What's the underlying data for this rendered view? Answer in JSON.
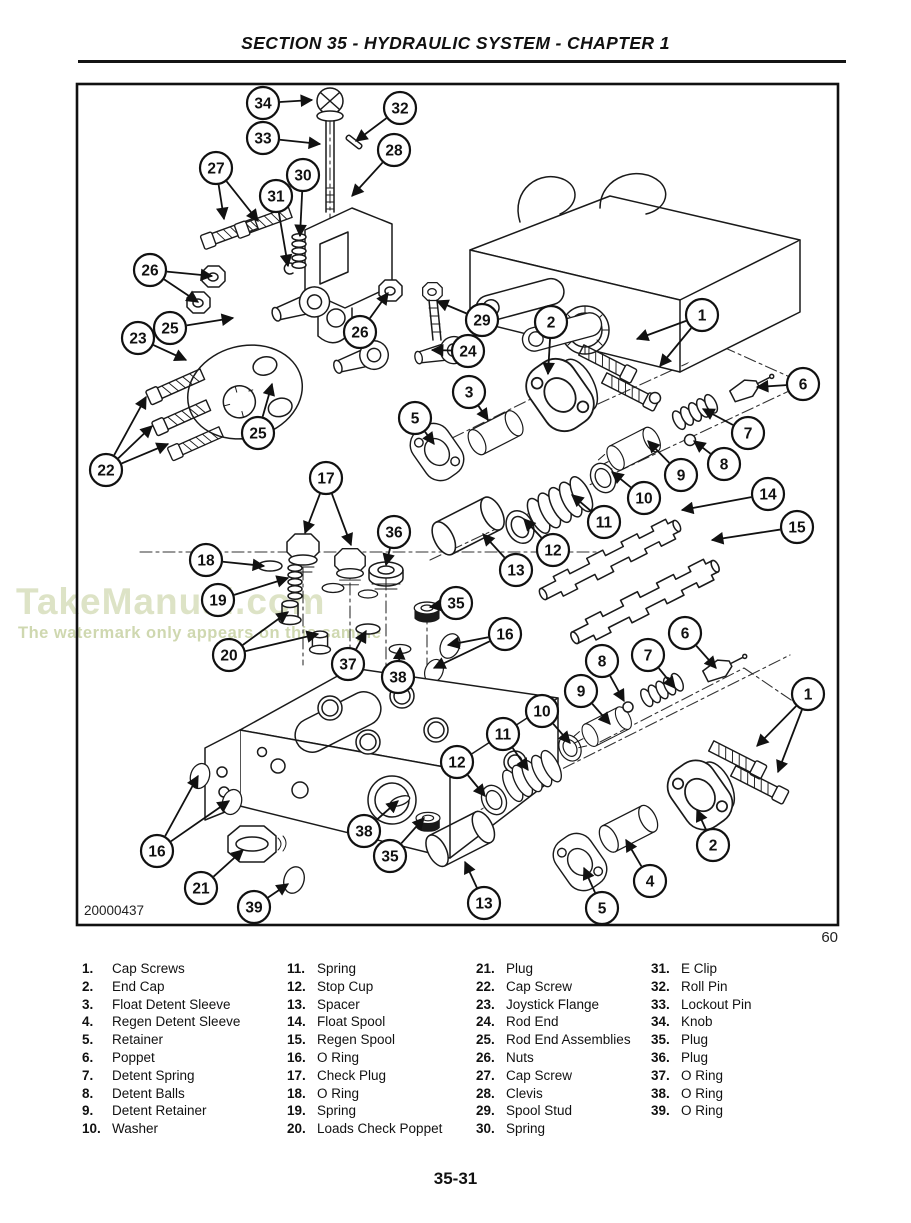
{
  "page": {
    "header_title": "SECTION 35 - HYDRAULIC SYSTEM - CHAPTER 1",
    "figure_number": "20000437",
    "figure_caption_number": "60",
    "footer_page_number": "35-31"
  },
  "watermark": {
    "title": "TakeManual.com",
    "subtitle": "The watermark only appears on this sample",
    "title_color": "#dde3c6",
    "subtitle_color": "#cfd8b0"
  },
  "diagram": {
    "description": "Exploded view of hydraulic joystick control valve",
    "callouts": [
      {
        "n": "34",
        "x": 263,
        "y": 103,
        "t": [
          [
            312,
            100
          ]
        ]
      },
      {
        "n": "32",
        "x": 400,
        "y": 108,
        "t": [
          [
            356,
            141
          ]
        ]
      },
      {
        "n": "33",
        "x": 263,
        "y": 138,
        "t": [
          [
            320,
            144
          ]
        ]
      },
      {
        "n": "28",
        "x": 394,
        "y": 150,
        "t": [
          [
            352,
            196
          ]
        ]
      },
      {
        "n": "27",
        "x": 216,
        "y": 168,
        "t": [
          [
            224,
            219
          ],
          [
            258,
            221
          ]
        ]
      },
      {
        "n": "30",
        "x": 303,
        "y": 175,
        "t": [
          [
            300,
            236
          ]
        ]
      },
      {
        "n": "31",
        "x": 276,
        "y": 196,
        "t": [
          [
            288,
            266
          ]
        ]
      },
      {
        "n": "26",
        "x": 150,
        "y": 270,
        "t": [
          [
            212,
            276
          ],
          [
            198,
            302
          ]
        ]
      },
      {
        "n": "25",
        "x": 170,
        "y": 328,
        "t": [
          [
            233,
            318
          ]
        ]
      },
      {
        "n": "23",
        "x": 138,
        "y": 338,
        "t": [
          [
            186,
            360
          ]
        ]
      },
      {
        "n": "26",
        "x": 360,
        "y": 332,
        "t": [
          [
            388,
            293
          ]
        ]
      },
      {
        "n": "29",
        "x": 482,
        "y": 320,
        "t": [
          [
            437,
            301
          ]
        ]
      },
      {
        "n": "24",
        "x": 468,
        "y": 351,
        "t": [
          [
            432,
            350
          ]
        ]
      },
      {
        "n": "25",
        "x": 258,
        "y": 433,
        "t": [
          [
            272,
            384
          ]
        ]
      },
      {
        "n": "22",
        "x": 106,
        "y": 470,
        "t": [
          [
            146,
            397
          ],
          [
            152,
            426
          ],
          [
            168,
            444
          ]
        ]
      },
      {
        "n": "3",
        "x": 469,
        "y": 392,
        "t": [
          [
            488,
            420
          ]
        ]
      },
      {
        "n": "5",
        "x": 415,
        "y": 418,
        "t": [
          [
            434,
            444
          ]
        ]
      },
      {
        "n": "2",
        "x": 551,
        "y": 322,
        "t": [
          [
            548,
            374
          ]
        ]
      },
      {
        "n": "1",
        "x": 702,
        "y": 315,
        "t": [
          [
            637,
            339
          ],
          [
            660,
            366
          ]
        ]
      },
      {
        "n": "6",
        "x": 803,
        "y": 384,
        "t": [
          [
            757,
            387
          ]
        ]
      },
      {
        "n": "7",
        "x": 748,
        "y": 433,
        "t": [
          [
            703,
            409
          ]
        ]
      },
      {
        "n": "8",
        "x": 724,
        "y": 464,
        "t": [
          [
            694,
            441
          ]
        ]
      },
      {
        "n": "9",
        "x": 681,
        "y": 475,
        "t": [
          [
            648,
            441
          ]
        ]
      },
      {
        "n": "10",
        "x": 644,
        "y": 498,
        "t": [
          [
            612,
            472
          ]
        ]
      },
      {
        "n": "11",
        "x": 604,
        "y": 522,
        "t": [
          [
            572,
            495
          ]
        ]
      },
      {
        "n": "12",
        "x": 553,
        "y": 550,
        "t": [
          [
            524,
            519
          ]
        ]
      },
      {
        "n": "14",
        "x": 768,
        "y": 494,
        "t": [
          [
            682,
            510
          ]
        ]
      },
      {
        "n": "15",
        "x": 797,
        "y": 527,
        "t": [
          [
            712,
            540
          ]
        ]
      },
      {
        "n": "13",
        "x": 516,
        "y": 570,
        "t": [
          [
            483,
            534
          ]
        ]
      },
      {
        "n": "17",
        "x": 326,
        "y": 478,
        "t": [
          [
            305,
            533
          ],
          [
            351,
            545
          ]
        ]
      },
      {
        "n": "18",
        "x": 206,
        "y": 560,
        "t": [
          [
            264,
            566
          ]
        ]
      },
      {
        "n": "19",
        "x": 218,
        "y": 600,
        "t": [
          [
            288,
            578
          ]
        ]
      },
      {
        "n": "36",
        "x": 394,
        "y": 532,
        "t": [
          [
            386,
            565
          ]
        ]
      },
      {
        "n": "35",
        "x": 456,
        "y": 603,
        "t": [
          [
            430,
            607
          ]
        ]
      },
      {
        "n": "16",
        "x": 505,
        "y": 634,
        "t": [
          [
            448,
            645
          ],
          [
            434,
            668
          ]
        ]
      },
      {
        "n": "20",
        "x": 229,
        "y": 655,
        "t": [
          [
            288,
            612
          ],
          [
            318,
            634
          ]
        ]
      },
      {
        "n": "37",
        "x": 348,
        "y": 664,
        "t": [
          [
            366,
            631
          ]
        ]
      },
      {
        "n": "38",
        "x": 398,
        "y": 677,
        "t": [
          [
            400,
            648
          ]
        ]
      },
      {
        "n": "6",
        "x": 685,
        "y": 633,
        "t": [
          [
            716,
            668
          ]
        ]
      },
      {
        "n": "7",
        "x": 648,
        "y": 655,
        "t": [
          [
            675,
            688
          ]
        ]
      },
      {
        "n": "8",
        "x": 602,
        "y": 661,
        "t": [
          [
            624,
            701
          ]
        ]
      },
      {
        "n": "9",
        "x": 581,
        "y": 691,
        "t": [
          [
            610,
            724
          ]
        ]
      },
      {
        "n": "10",
        "x": 542,
        "y": 711,
        "t": [
          [
            570,
            743
          ]
        ]
      },
      {
        "n": "11",
        "x": 503,
        "y": 734,
        "t": [
          [
            528,
            770
          ]
        ]
      },
      {
        "n": "12",
        "x": 457,
        "y": 762,
        "t": [
          [
            485,
            796
          ]
        ]
      },
      {
        "n": "1",
        "x": 808,
        "y": 694,
        "t": [
          [
            757,
            746
          ],
          [
            778,
            772
          ]
        ]
      },
      {
        "n": "2",
        "x": 713,
        "y": 845,
        "t": [
          [
            697,
            810
          ]
        ]
      },
      {
        "n": "4",
        "x": 650,
        "y": 881,
        "t": [
          [
            626,
            840
          ]
        ]
      },
      {
        "n": "5",
        "x": 602,
        "y": 908,
        "t": [
          [
            584,
            868
          ]
        ]
      },
      {
        "n": "13",
        "x": 484,
        "y": 903,
        "t": [
          [
            465,
            862
          ]
        ]
      },
      {
        "n": "35",
        "x": 390,
        "y": 856,
        "t": [
          [
            424,
            818
          ]
        ]
      },
      {
        "n": "38",
        "x": 364,
        "y": 831,
        "t": [
          [
            398,
            801
          ]
        ]
      },
      {
        "n": "16",
        "x": 157,
        "y": 851,
        "t": [
          [
            198,
            776
          ],
          [
            229,
            801
          ]
        ]
      },
      {
        "n": "21",
        "x": 201,
        "y": 888,
        "t": [
          [
            243,
            850
          ]
        ]
      },
      {
        "n": "39",
        "x": 254,
        "y": 907,
        "t": [
          [
            288,
            884
          ]
        ]
      }
    ]
  },
  "parts_list": {
    "columns": [
      [
        {
          "num": "1.",
          "label": "Cap Screws"
        },
        {
          "num": "2.",
          "label": "End Cap"
        },
        {
          "num": "3.",
          "label": "Float Detent Sleeve"
        },
        {
          "num": "4.",
          "label": "Regen Detent Sleeve"
        },
        {
          "num": "5.",
          "label": "Retainer"
        },
        {
          "num": "6.",
          "label": "Poppet"
        },
        {
          "num": "7.",
          "label": "Detent Spring"
        },
        {
          "num": "8.",
          "label": "Detent Balls"
        },
        {
          "num": "9.",
          "label": "Detent Retainer"
        },
        {
          "num": "10.",
          "label": "Washer"
        }
      ],
      [
        {
          "num": "11.",
          "label": "Spring"
        },
        {
          "num": "12.",
          "label": "Stop Cup"
        },
        {
          "num": "13.",
          "label": "Spacer"
        },
        {
          "num": "14.",
          "label": "Float Spool"
        },
        {
          "num": "15.",
          "label": "Regen Spool"
        },
        {
          "num": "16.",
          "label": "O Ring"
        },
        {
          "num": "17.",
          "label": "Check Plug"
        },
        {
          "num": "18.",
          "label": "O Ring"
        },
        {
          "num": "19.",
          "label": "Spring"
        },
        {
          "num": "20.",
          "label": "Loads Check Poppet"
        }
      ],
      [
        {
          "num": "21.",
          "label": "Plug"
        },
        {
          "num": "22.",
          "label": "Cap Screw"
        },
        {
          "num": "23.",
          "label": "Joystick Flange"
        },
        {
          "num": "24.",
          "label": "Rod End"
        },
        {
          "num": "25.",
          "label": "Rod End Assemblies"
        },
        {
          "num": "26.",
          "label": "Nuts"
        },
        {
          "num": "27.",
          "label": "Cap Screw"
        },
        {
          "num": "28.",
          "label": "Clevis"
        },
        {
          "num": "29.",
          "label": "Spool Stud"
        },
        {
          "num": "30.",
          "label": "Spring"
        }
      ],
      [
        {
          "num": "31.",
          "label": "E Clip"
        },
        {
          "num": "32.",
          "label": "Roll Pin"
        },
        {
          "num": "33.",
          "label": "Lockout Pin"
        },
        {
          "num": "34.",
          "label": "Knob"
        },
        {
          "num": "35.",
          "label": "Plug"
        },
        {
          "num": "36.",
          "label": "Plug"
        },
        {
          "num": "37.",
          "label": "O Ring"
        },
        {
          "num": "38.",
          "label": "O Ring"
        },
        {
          "num": "39.",
          "label": "O Ring"
        }
      ]
    ]
  }
}
